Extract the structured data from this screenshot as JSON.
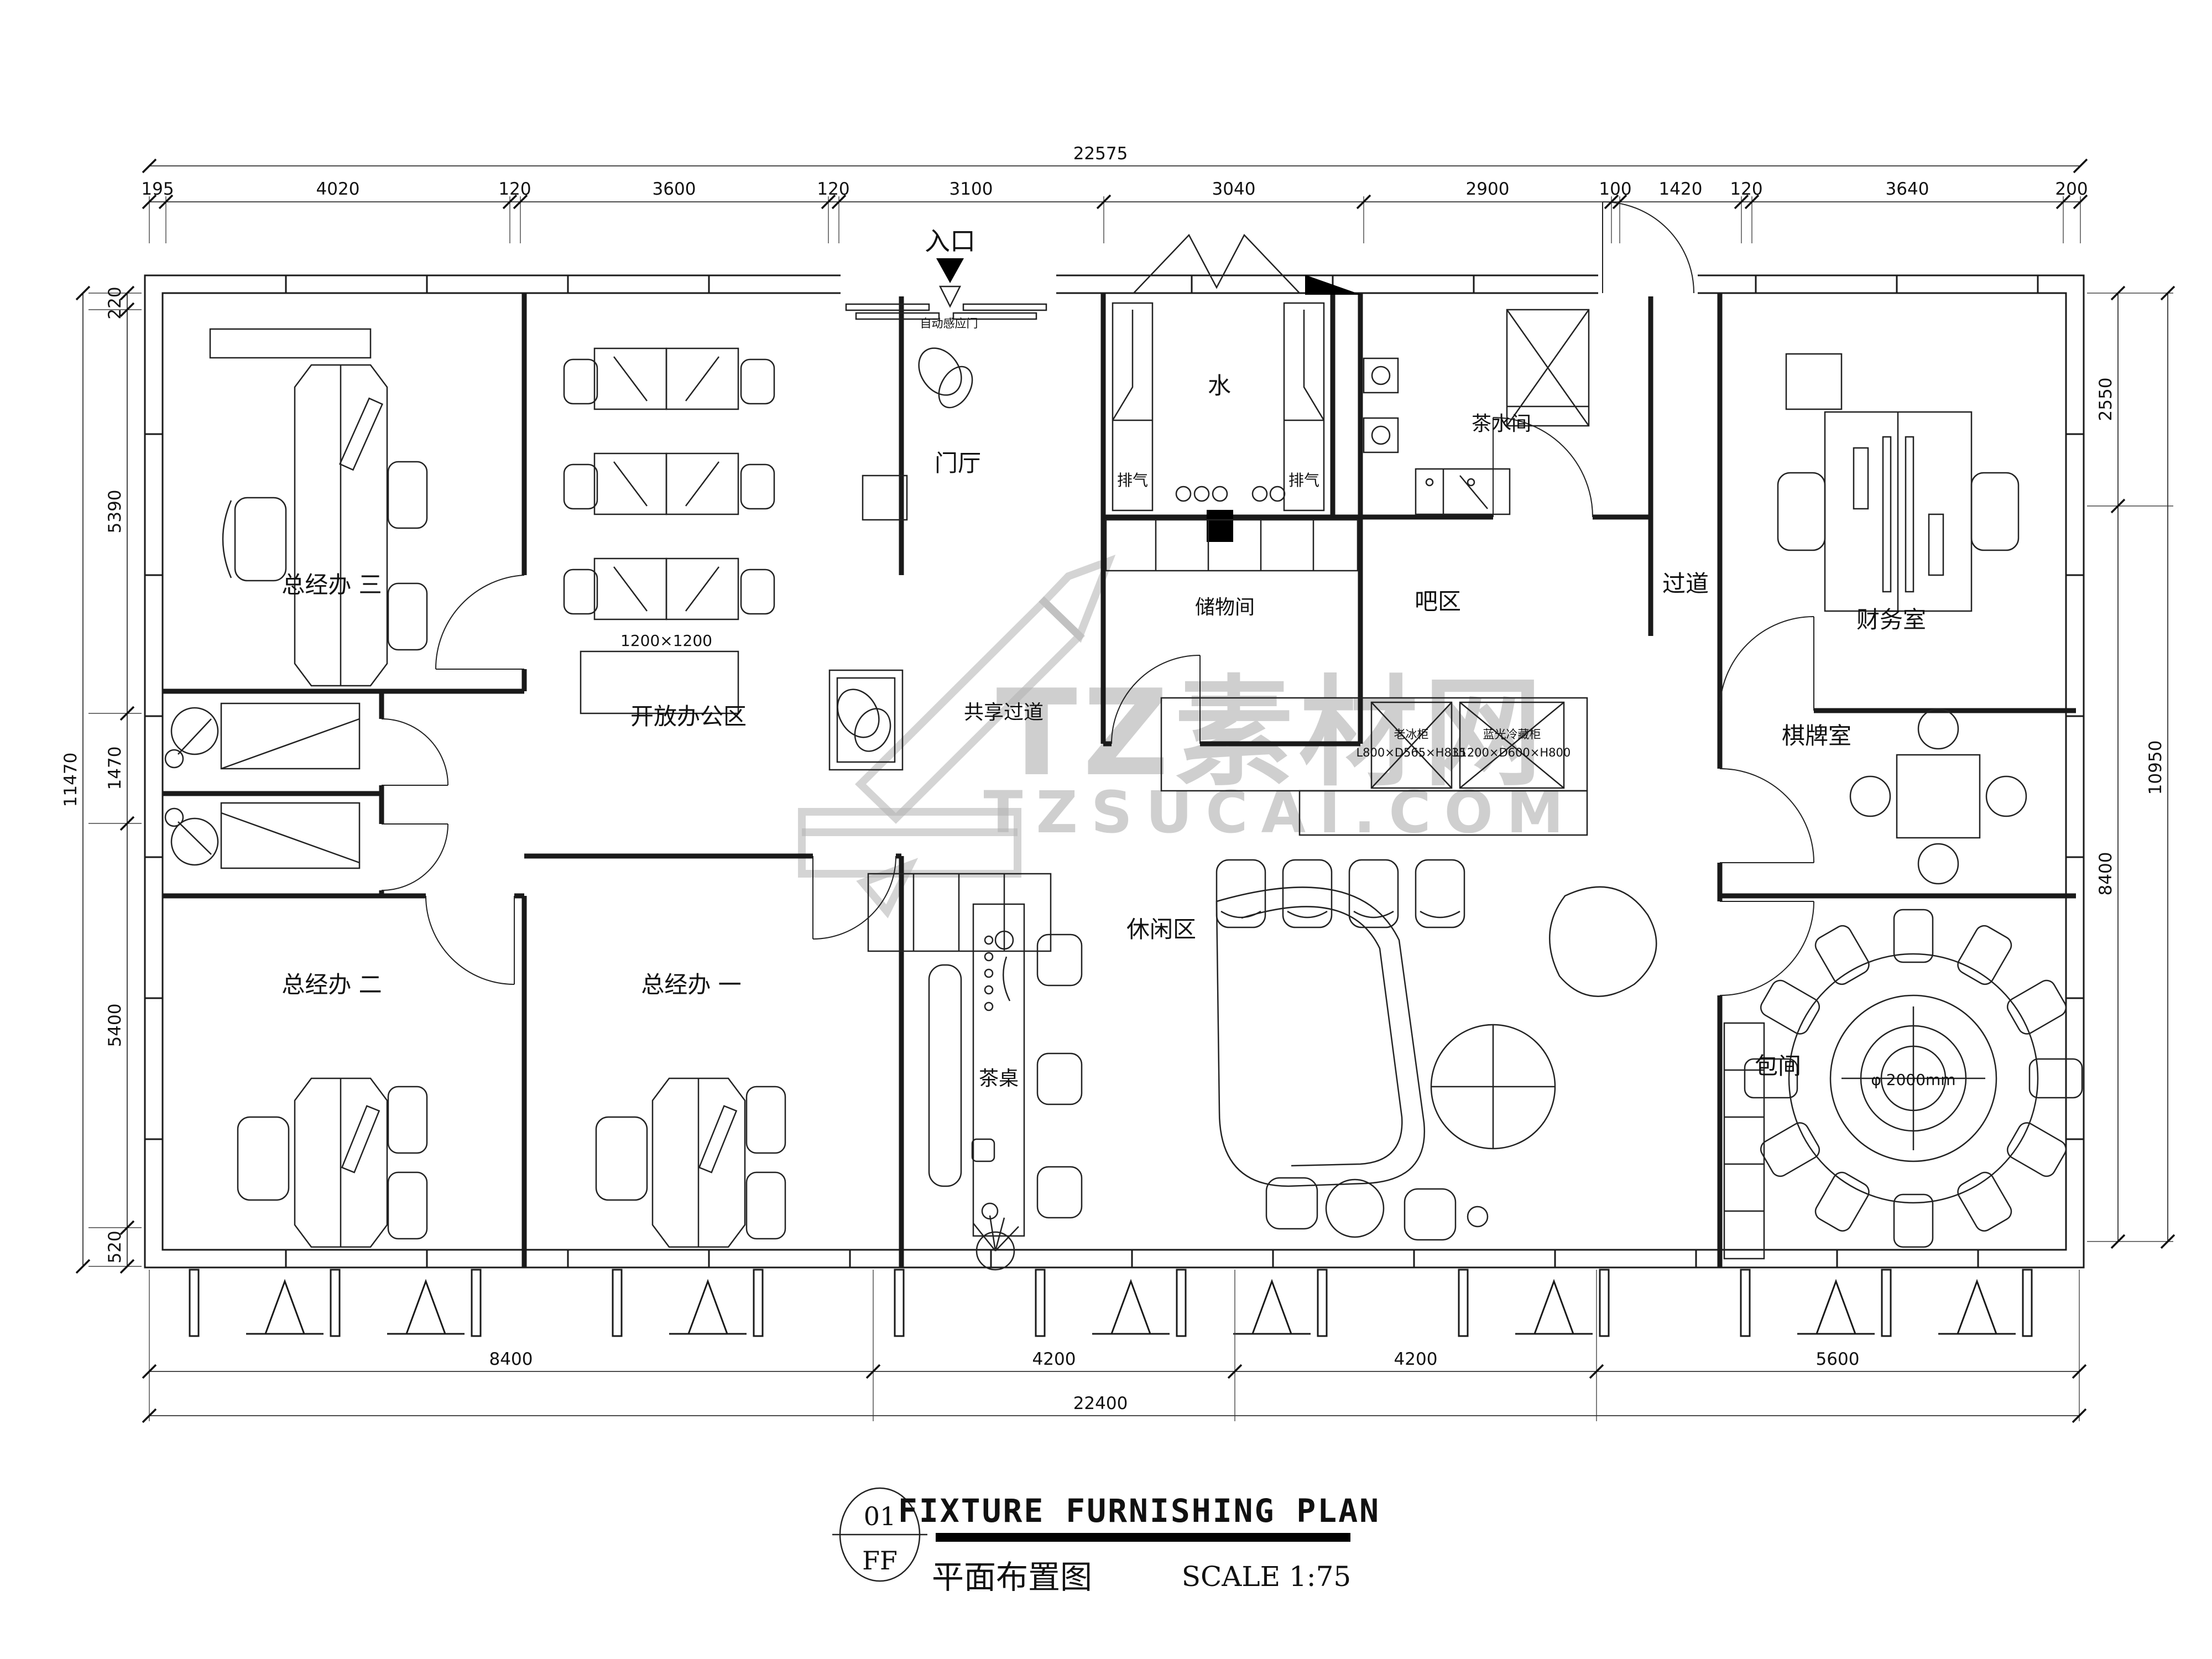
{
  "watermark": {
    "logo": "TZ素材网",
    "site": "TZSUCAI.COM"
  },
  "entrance": {
    "label": "入口",
    "door": "自动感应门"
  },
  "rooms": {
    "gm3": "总经办 三",
    "gm2": "总经办 二",
    "gm1": "总经办 一",
    "open_office": "开放办公区",
    "desk_size": "1200×1200",
    "foyer": "门厅",
    "shared_corridor": "共享过道",
    "water": "水",
    "exhaust_left": "排气",
    "exhaust_right": "排气",
    "storage": "储物间",
    "tea_room": "茶水间",
    "bar": "吧区",
    "corridor": "过道",
    "finance": "财务室",
    "chess": "棋牌室",
    "leisure": "休闲区",
    "tea_table": "茶桌",
    "private_room": "包间",
    "round_table": "φ 2000mm",
    "fridge_name": "老冰柜",
    "fridge_size": "L800×D565×H835",
    "cooler_name": "蓝光冷藏柜",
    "cooler_size": "L1200×D600×H800"
  },
  "dims": {
    "top_total": "22575",
    "top_segments": [
      "195",
      "4020",
      "120",
      "3600",
      "120",
      "3100",
      "3040",
      "2900",
      "100",
      "1420",
      "120",
      "3640",
      "200"
    ],
    "left_total": "11470",
    "left_segments": [
      "220",
      "5390",
      "1470",
      "5400",
      "520"
    ],
    "right_total": "10950",
    "right_segments": [
      "2550",
      "8400"
    ],
    "bottom_segments": [
      "8400",
      "4200",
      "4200",
      "5600"
    ],
    "bottom_total": "22400"
  },
  "titleblock": {
    "number": "01",
    "code": "FF",
    "title_en": "FIXTURE FURNISHING PLAN",
    "title_cn": "平面布置图",
    "scale": "SCALE 1:75"
  }
}
